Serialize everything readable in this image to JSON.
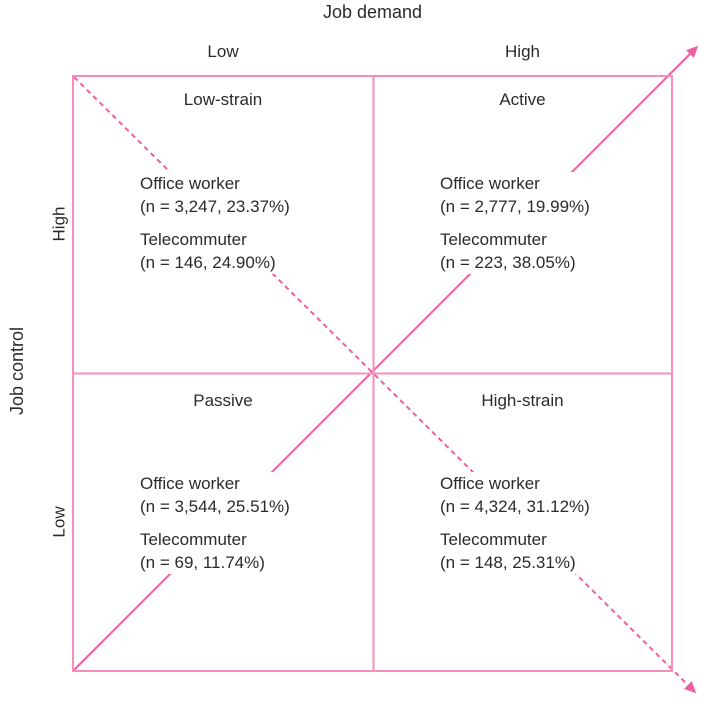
{
  "diagram": {
    "x_axis": {
      "title": "Job demand",
      "left_label": "Low",
      "right_label": "High"
    },
    "y_axis": {
      "title": "Job control",
      "top_label": "High",
      "bottom_label": "Low"
    },
    "quadrants": [
      {
        "key": "low-strain",
        "title": "Low-strain",
        "groups": [
          {
            "name": "Office worker",
            "stat": "(n = 3,247, 23.37%)"
          },
          {
            "name": "Telecommuter",
            "stat": "(n = 146, 24.90%)"
          }
        ]
      },
      {
        "key": "active",
        "title": "Active",
        "groups": [
          {
            "name": "Office worker",
            "stat": "(n = 2,777, 19.99%)"
          },
          {
            "name": "Telecommuter",
            "stat": "(n = 223, 38.05%)"
          }
        ]
      },
      {
        "key": "passive",
        "title": "Passive",
        "groups": [
          {
            "name": "Office worker",
            "stat": "(n = 3,544, 25.51%)"
          },
          {
            "name": "Telecommuter",
            "stat": "(n = 69, 11.74%)"
          }
        ]
      },
      {
        "key": "high-strain",
        "title": "High-strain",
        "groups": [
          {
            "name": "Office worker",
            "stat": "(n = 4,324, 31.12%)"
          },
          {
            "name": "Telecommuter",
            "stat": "(n = 148, 25.31%)"
          }
        ]
      }
    ],
    "colors": {
      "grid_pink": "#f48fbc",
      "arrow_pink": "#ee5f9f",
      "text": "#2b2b2b",
      "background": "#ffffff"
    }
  }
}
